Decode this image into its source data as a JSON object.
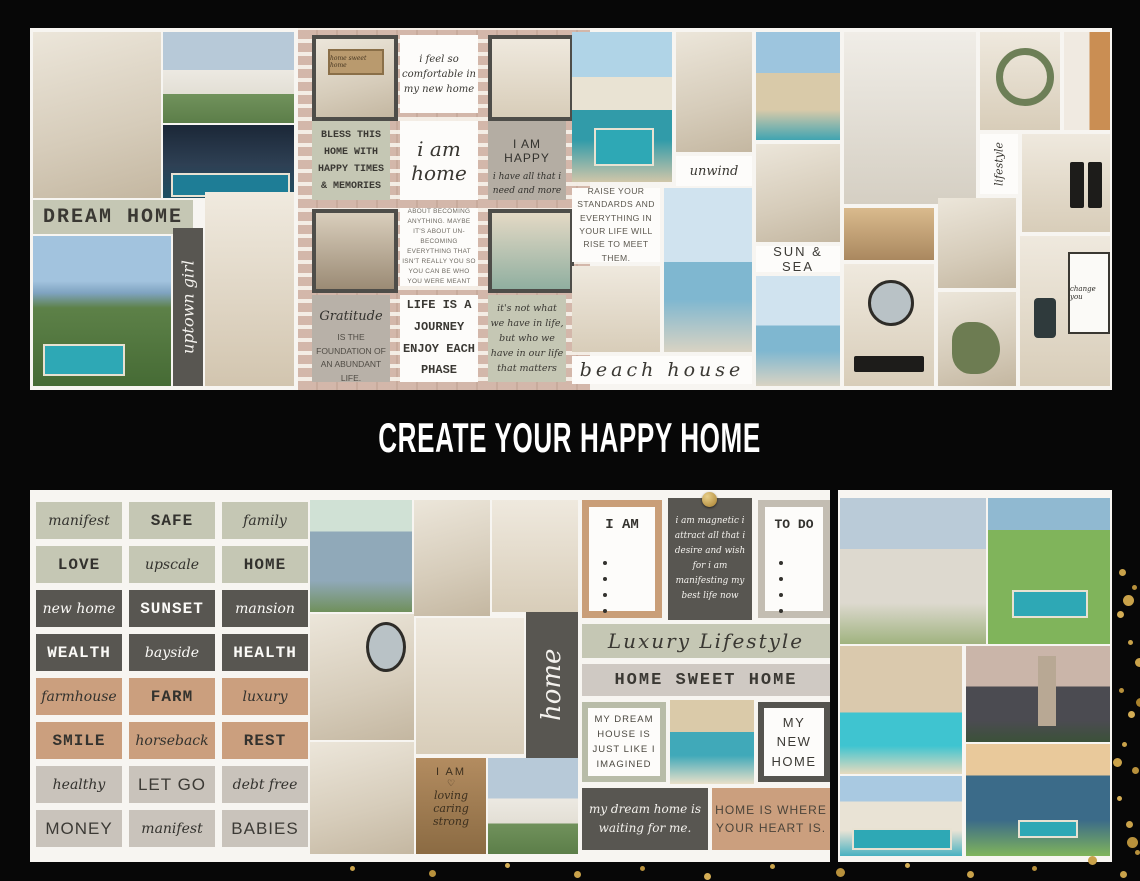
{
  "title": {
    "text": "CREATE YOUR HAPPY HOME"
  },
  "colors": {
    "background": "#070707",
    "board": "#f7f5f1",
    "sage": "#c5c7b4",
    "dark_gray": "#585651",
    "tan": "#cb9f7e",
    "greige": "#c9c3bb",
    "taupe": "#b4ada3",
    "gold": "#c9a24a"
  },
  "top_board": {
    "cards": {
      "dream_home": "DREAM HOME",
      "uptown_girl": "uptown girl",
      "home_sign": "home sweet home",
      "comfortable": "i feel so comfortable in my new home",
      "bless": "BLESS THIS HOME WITH HAPPY TIMES & MEMORIES",
      "i_am_home": "i am home",
      "i_am_happy": "I AM HAPPY",
      "i_am_happy_sub": "i have all that i need and more",
      "maybe_journey": "MAYBE THE JOURNEY ISN'T SO MUCH ABOUT BECOMING ANYTHING. MAYBE IT'S ABOUT UN-BECOMING EVERYTHING THAT ISN'T REALLY YOU SO YOU CAN BE WHO YOU WERE MEANT TO BE IN THE FIRST PLACE.",
      "gratitude": "Gratitude",
      "gratitude_sub": "IS THE FOUNDATION OF AN ABUNDANT LIFE.",
      "life_journey": "LIFE IS A JOURNEY ENJOY EACH PHASE",
      "who_we_have": "it's not what we have in life, but who we have in our life that matters",
      "unwind": "unwind",
      "raise": "RAISE YOUR STANDARDS AND EVERYTHING IN YOUR LIFE WILL RISE TO MEET THEM.",
      "beach_house": "beach house",
      "sun_sea": "SUN & SEA",
      "lifestyle": "lifestyle",
      "change_sign": "change you"
    }
  },
  "bottom_board": {
    "stickers": [
      {
        "label": "manifest"
      },
      {
        "label": "SAFE"
      },
      {
        "label": "family"
      },
      {
        "label": "LOVE"
      },
      {
        "label": "upscale"
      },
      {
        "label": "HOME"
      },
      {
        "label": "new home"
      },
      {
        "label": "SUNSET"
      },
      {
        "label": "mansion"
      },
      {
        "label": "WEALTH"
      },
      {
        "label": "bayside"
      },
      {
        "label": "HEALTH"
      },
      {
        "label": "farmhouse"
      },
      {
        "label": "FARM"
      },
      {
        "label": "luxury"
      },
      {
        "label": "SMILE"
      },
      {
        "label": "horseback"
      },
      {
        "label": "REST"
      },
      {
        "label": "healthy"
      },
      {
        "label": "LET GO"
      },
      {
        "label": "debt free"
      },
      {
        "label": "MONEY"
      },
      {
        "label": "manifest"
      },
      {
        "label": "BABIES"
      }
    ],
    "cards": {
      "home_vertical": "home",
      "i_am_title": "I AM",
      "to_do_title": "TO DO",
      "magnetic": "i am magnetic i attract all that i desire and wish for i am manifesting my best life now",
      "luxury_lifestyle": "Luxury Lifestyle",
      "home_sweet_home": "HOME SWEET HOME",
      "my_dream_house": "MY DREAM HOUSE IS JUST LIKE I IMAGINED",
      "my_new_home": "MY NEW HOME",
      "waiting": "my dream home is waiting for me.",
      "heart": "HOME IS WHERE YOUR HEART IS.",
      "wood_title": "I AM",
      "wood_heart": "♡",
      "wood_words": [
        "loving",
        "caring",
        "strong"
      ]
    }
  }
}
